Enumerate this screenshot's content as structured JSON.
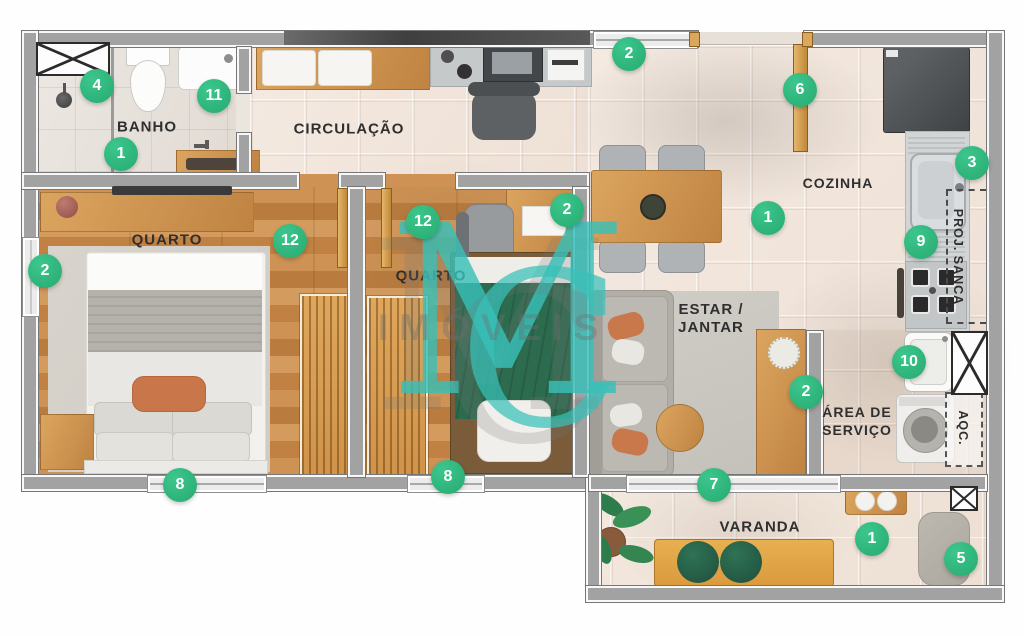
{
  "plan": {
    "watermark": {
      "initial_m": "M",
      "initial_c": "C",
      "word": "IMÓVEIS"
    },
    "rooms": {
      "banho": "BANHO",
      "circulacao": "CIRCULAÇÃO",
      "cozinha": "COZINHA",
      "quarto1": "QUARTO",
      "quarto2": "QUARTO",
      "estar_line1": "ESTAR /",
      "estar_line2": "JANTAR",
      "area_line1": "ÁREA DE",
      "area_line2": "SERVIÇO",
      "varanda": "VARANDA",
      "proj_sanca": "PROJ. SANCA",
      "aqc": "AQC."
    },
    "badges": [
      {
        "id": "banho-4",
        "number": "4"
      },
      {
        "id": "banho-11",
        "number": "11"
      },
      {
        "id": "banho-1",
        "number": "1"
      },
      {
        "id": "entry-window-2",
        "number": "2"
      },
      {
        "id": "entry-door-6",
        "number": "6"
      },
      {
        "id": "kitchen-3",
        "number": "3"
      },
      {
        "id": "kitchen-1",
        "number": "1"
      },
      {
        "id": "kitchen-9",
        "number": "9"
      },
      {
        "id": "quarto1-2",
        "number": "2"
      },
      {
        "id": "quarto1-12",
        "number": "12"
      },
      {
        "id": "quarto2-12",
        "number": "12"
      },
      {
        "id": "quarto2-2",
        "number": "2"
      },
      {
        "id": "servico-10",
        "number": "10"
      },
      {
        "id": "estar-2",
        "number": "2"
      },
      {
        "id": "quarto1-8",
        "number": "8"
      },
      {
        "id": "quarto2-8",
        "number": "8"
      },
      {
        "id": "estar-7",
        "number": "7"
      },
      {
        "id": "varanda-1",
        "number": "1"
      },
      {
        "id": "varanda-5",
        "number": "5"
      }
    ],
    "colors": {
      "badge_green": "#2eb67d",
      "watermark_teal": "#38c0b8",
      "wall_gray": "#a2a2a2",
      "floor_tile": "#f2e7dd",
      "wood": "#c98e4f",
      "bedding_green": "#2d6b4e",
      "accent_orange": "#c9774a"
    }
  }
}
